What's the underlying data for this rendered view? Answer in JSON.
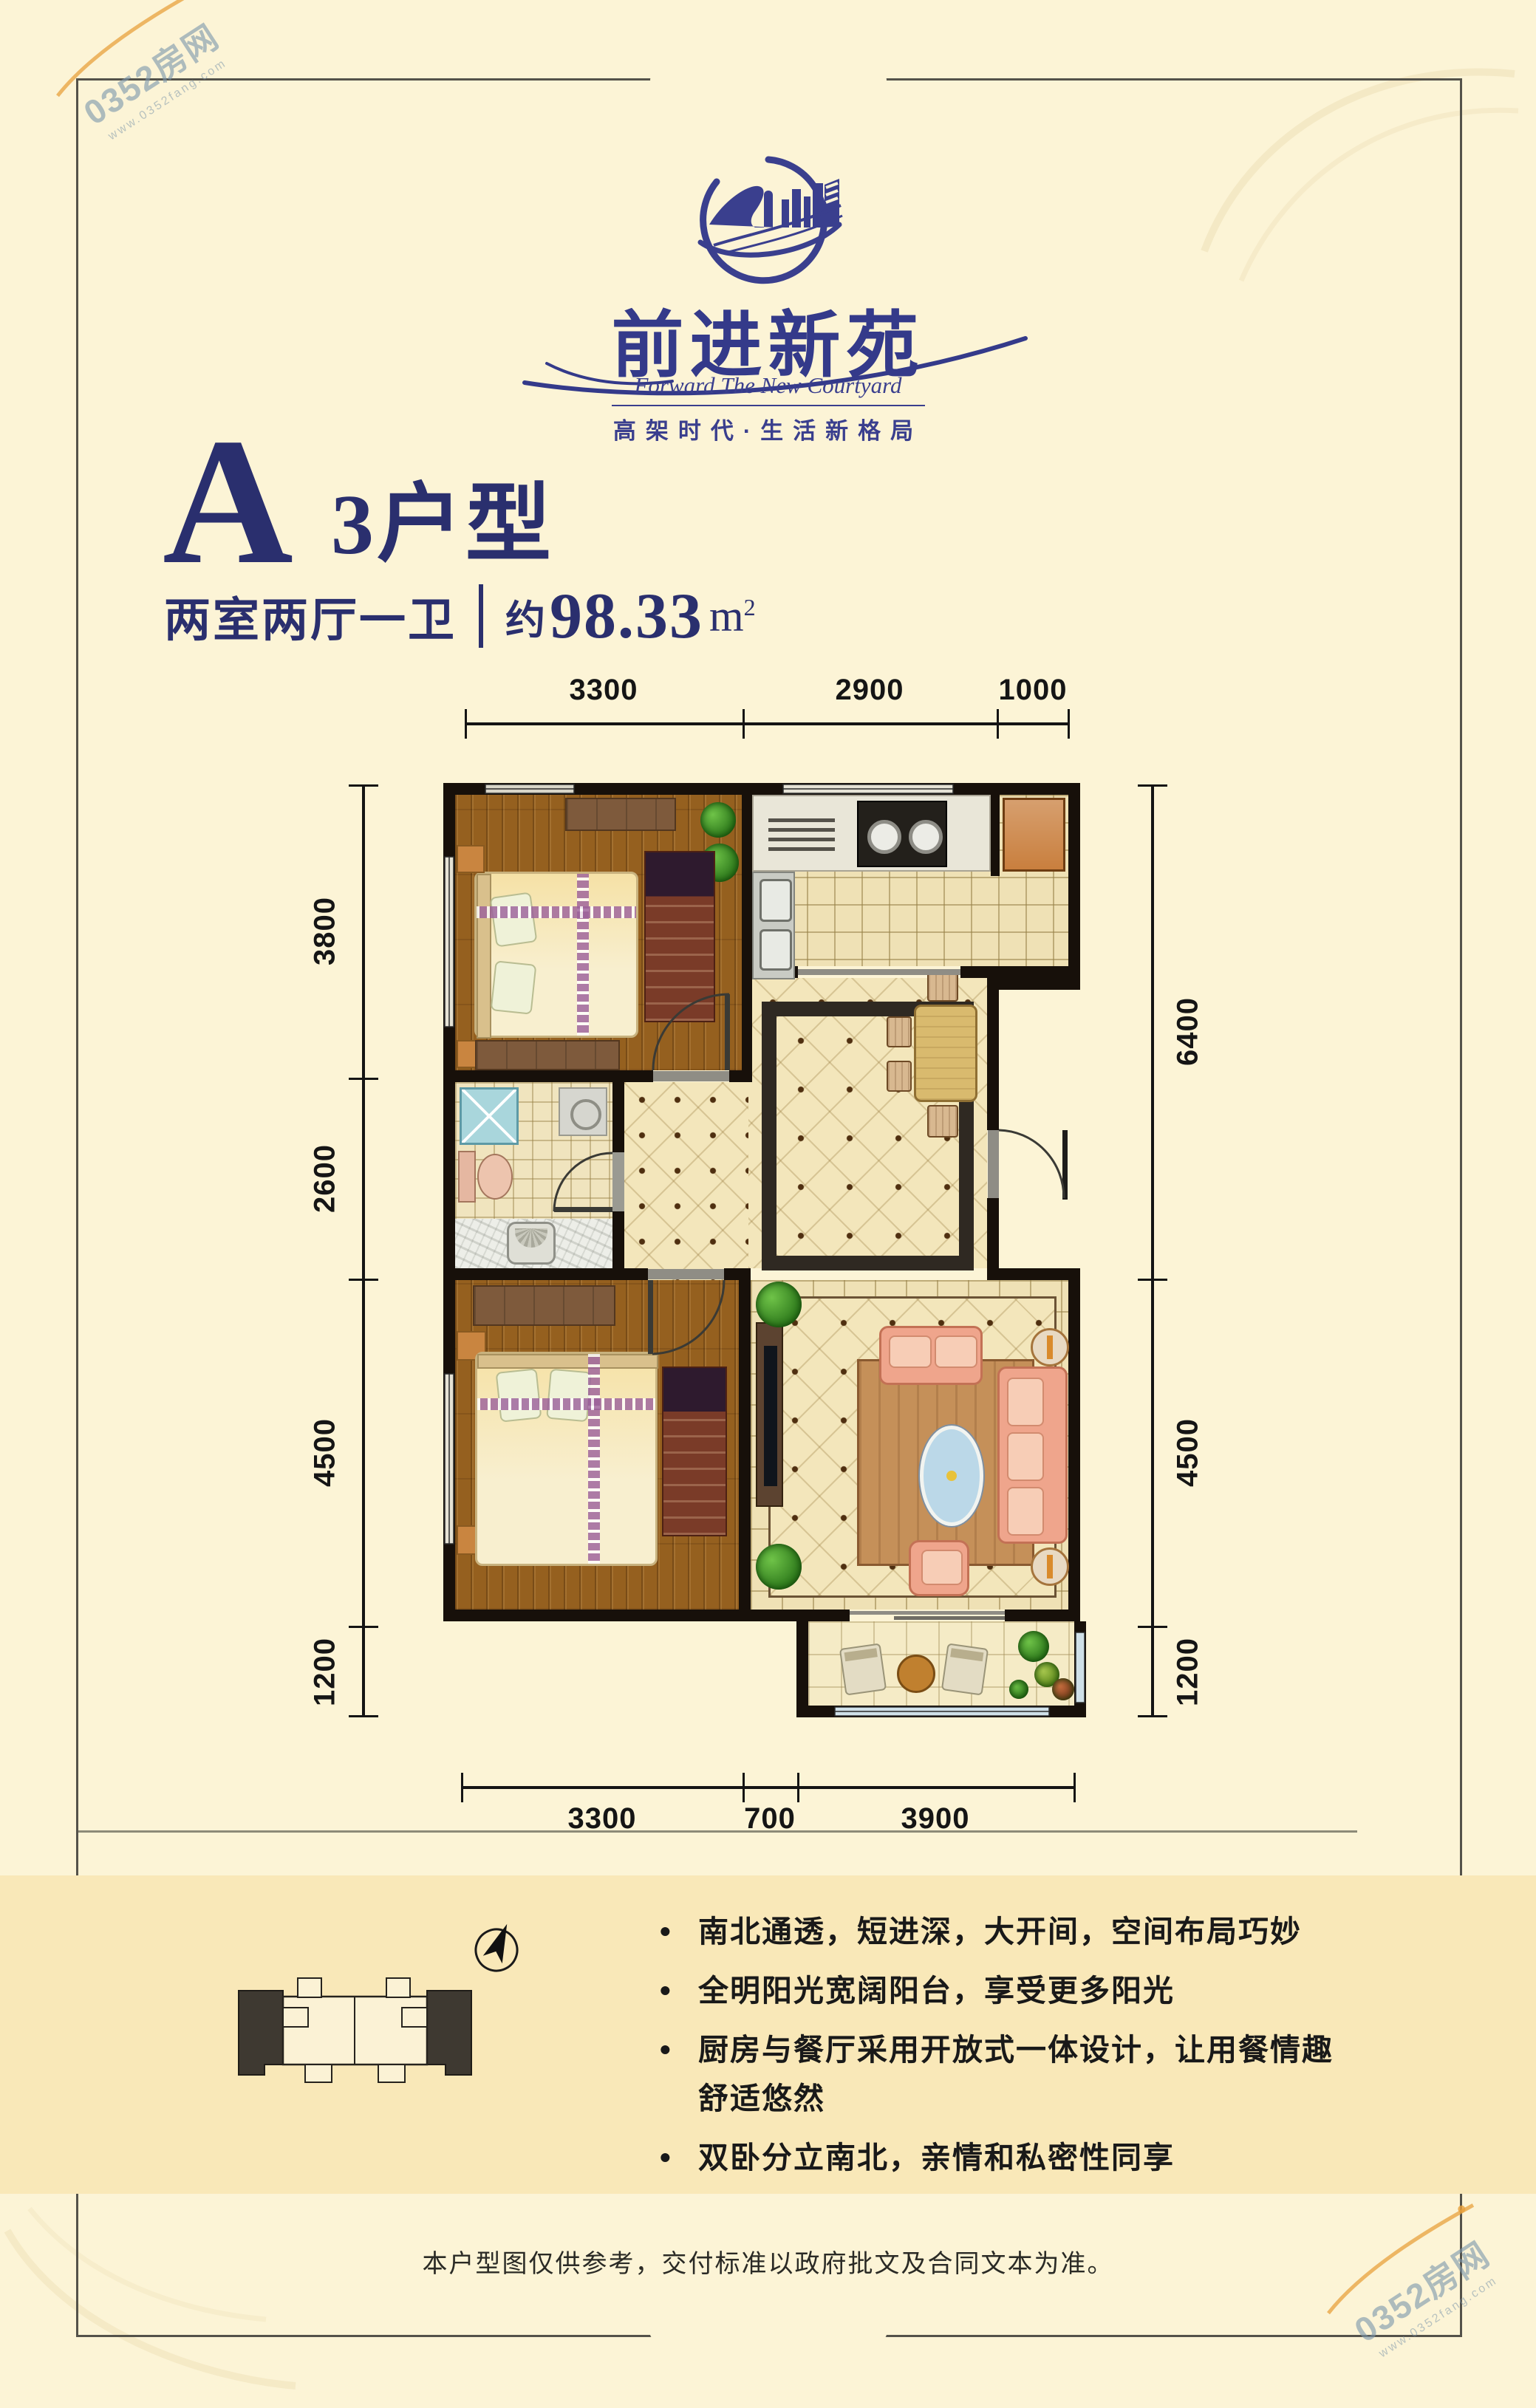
{
  "colors": {
    "brand_navy": "#2A2F6E",
    "logo_blue": "#3A3F8E",
    "page_bg": "#FCF4D6",
    "band_bg": "#F9E8B8",
    "wall": "#17100A",
    "accent_orange": "#E8A13C"
  },
  "watermark": {
    "brand": "0352房网",
    "url": "www.0352fang.com"
  },
  "logo": {
    "cn": "前进新苑",
    "en": "Forward The New Courtyard",
    "tagline": "高架时代·生活新格局"
  },
  "unit": {
    "title_letter": "A",
    "title_rest": "3户型",
    "rooms": "两室两厅一卫",
    "area_prefix": "约",
    "area_value": "98.33",
    "area_unit": "m",
    "area_exp": "2"
  },
  "dimensions": {
    "top": [
      "3300",
      "2900",
      "1000"
    ],
    "bottom": [
      "3300",
      "700",
      "3900"
    ],
    "left": [
      "3800",
      "2600",
      "4500",
      "1200"
    ],
    "right": [
      "6400",
      "4500",
      "1200"
    ]
  },
  "features_meta": {
    "bullet": "•"
  },
  "features": [
    "南北通透，短进深，大开间，空间布局巧妙",
    "全明阳光宽阔阳台，享受更多阳光",
    "厨房与餐厅采用开放式一体设计，让用餐情趣舒适悠然",
    "双卧分立南北，亲情和私密性同享"
  ],
  "disclaimer": "本户型图仅供参考，交付标准以政府批文及合同文本为准。"
}
